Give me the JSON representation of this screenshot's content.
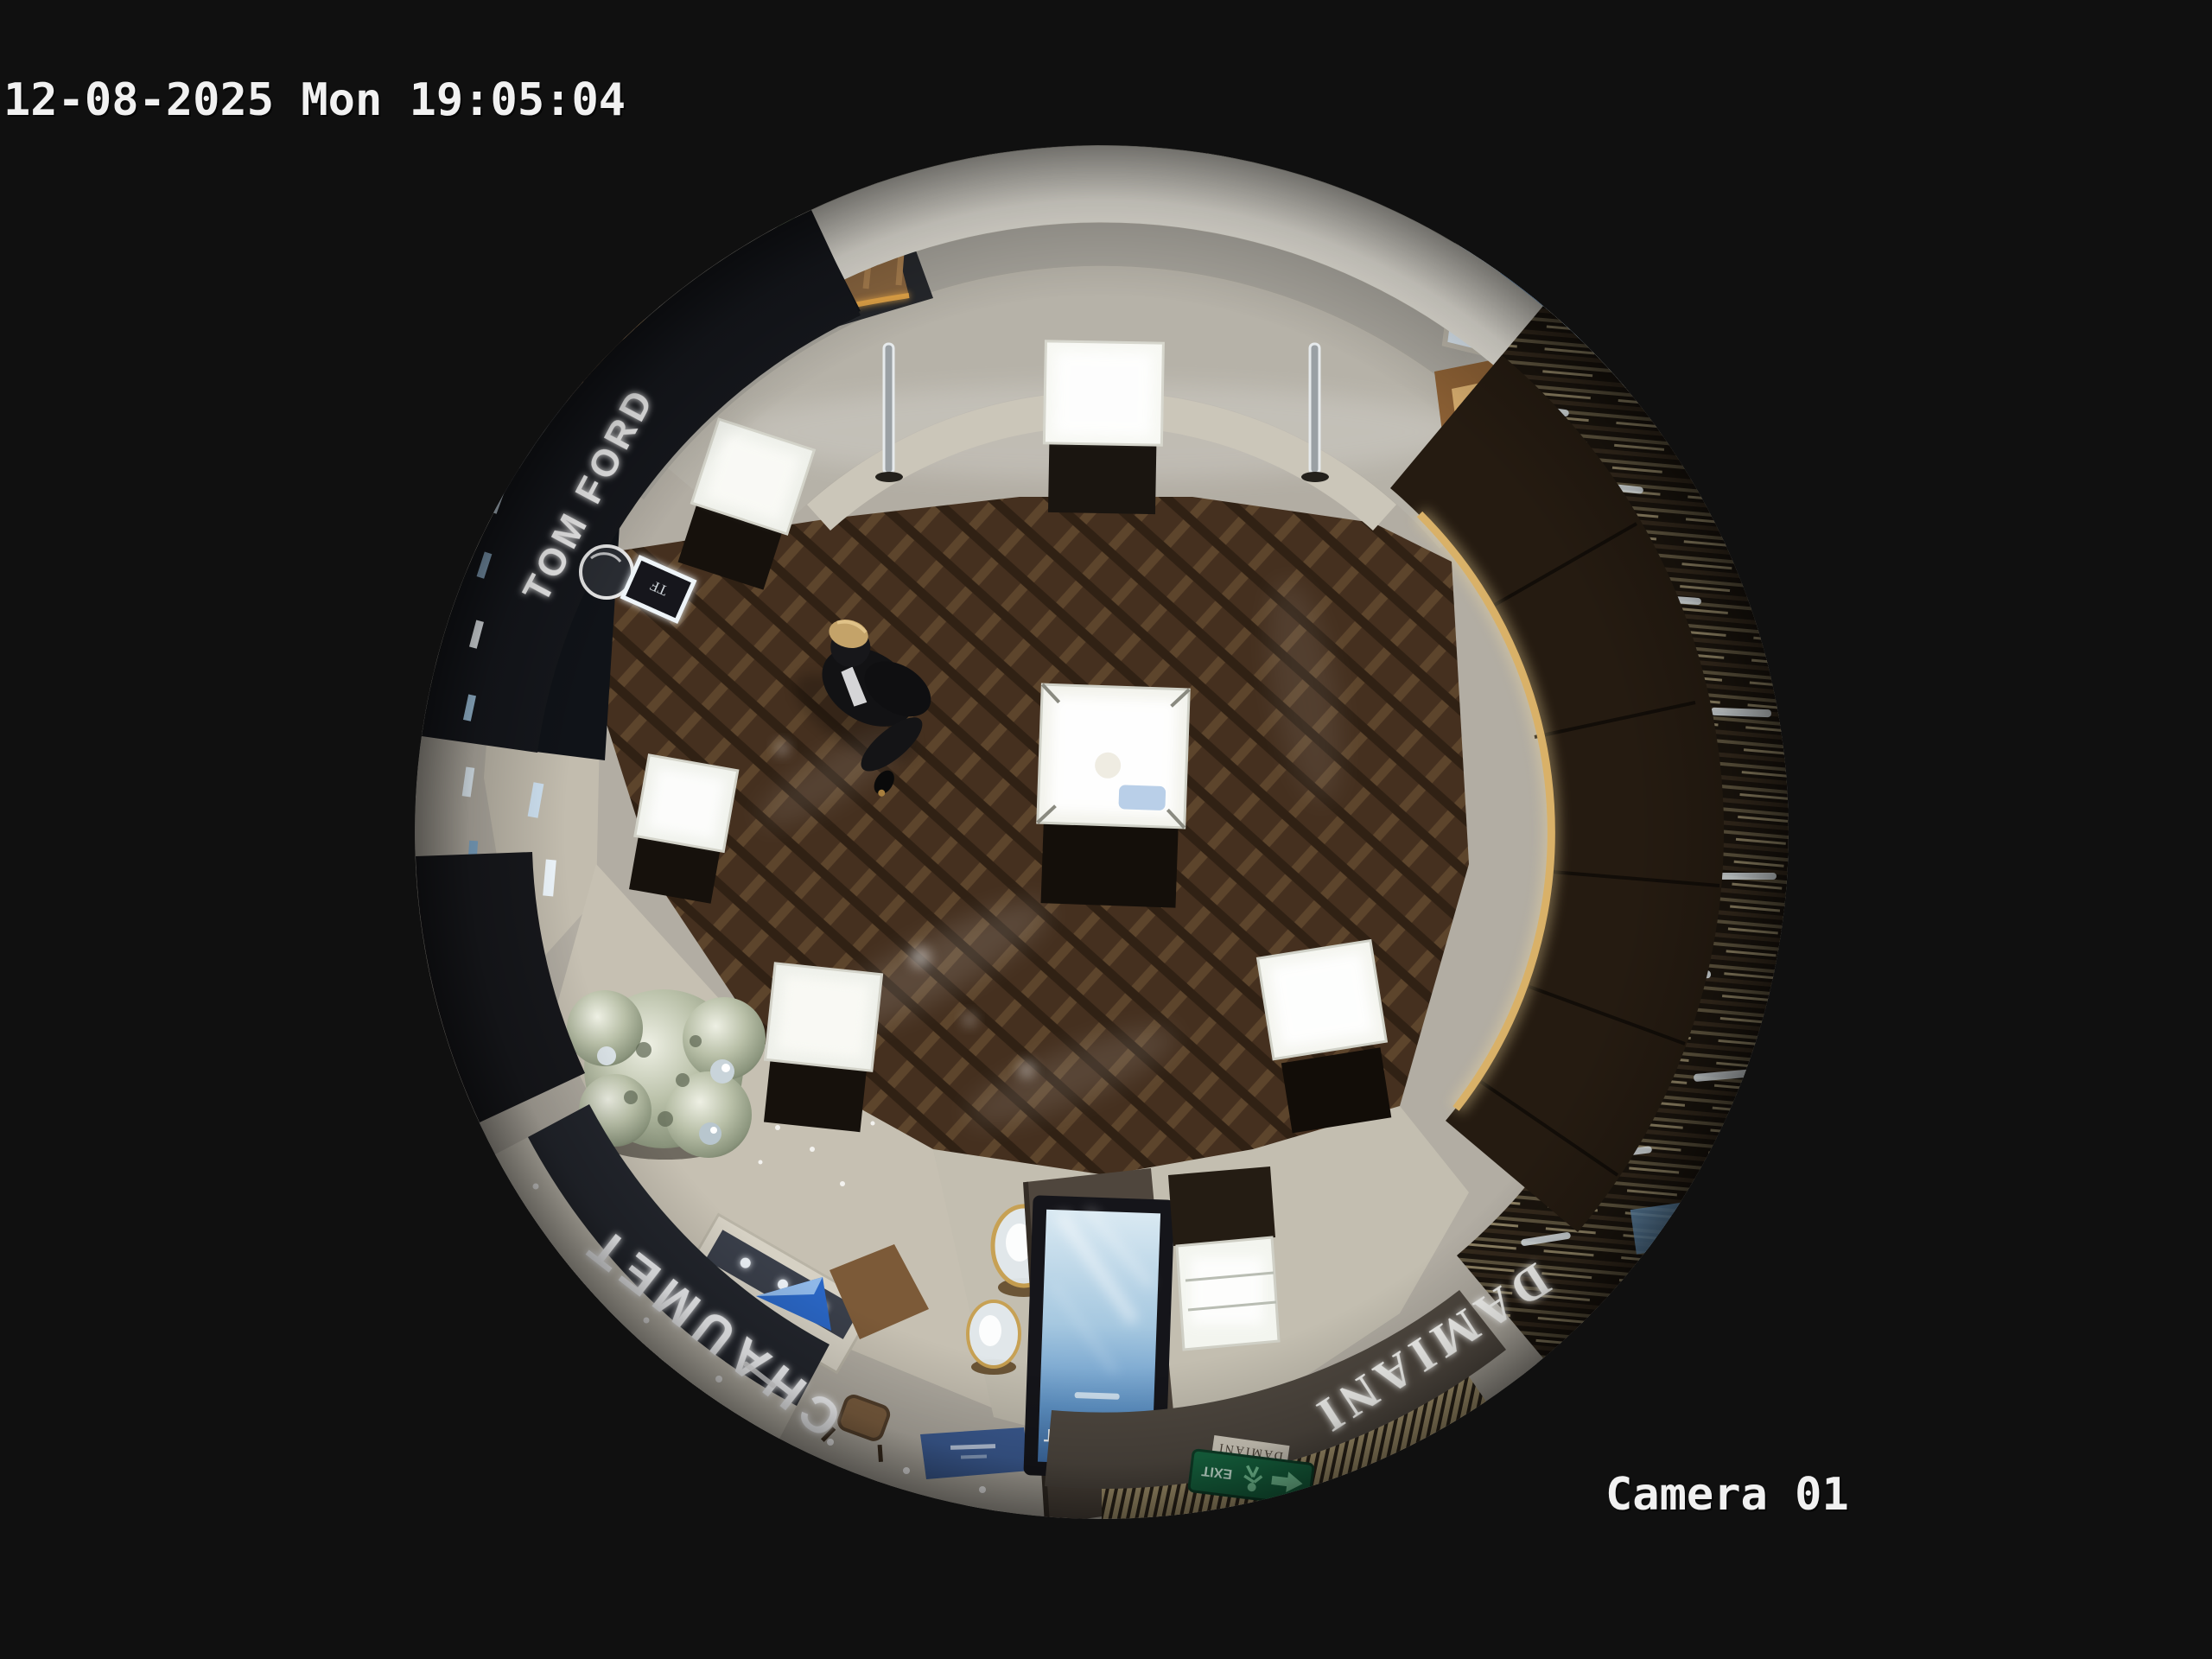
{
  "osd": {
    "timestamp": "12-08-2025 Mon 19:05:04",
    "camera_label": "Camera 01"
  },
  "scene": {
    "signs": {
      "tom_ford": "TOM FORD",
      "tf_monogram": "TF",
      "chaumet_fascia": "CHAUMET",
      "chaumet_screen": "CHAUMET",
      "damiani_fascia": "DAMIANI",
      "damiani_tag": "DAMIANI",
      "exit": "EXIT"
    },
    "colors": {
      "background": "#101010",
      "osd_text": "#f1f1f1",
      "marble_floor": "#b6b2a8",
      "wood_floor": "#45301f",
      "chaumet_band": "#23262d",
      "damiani_band": "#4f4840",
      "screen_blue": "#5e92c5",
      "exit_green": "#176a43",
      "gold_trim": "#d9b168"
    }
  }
}
